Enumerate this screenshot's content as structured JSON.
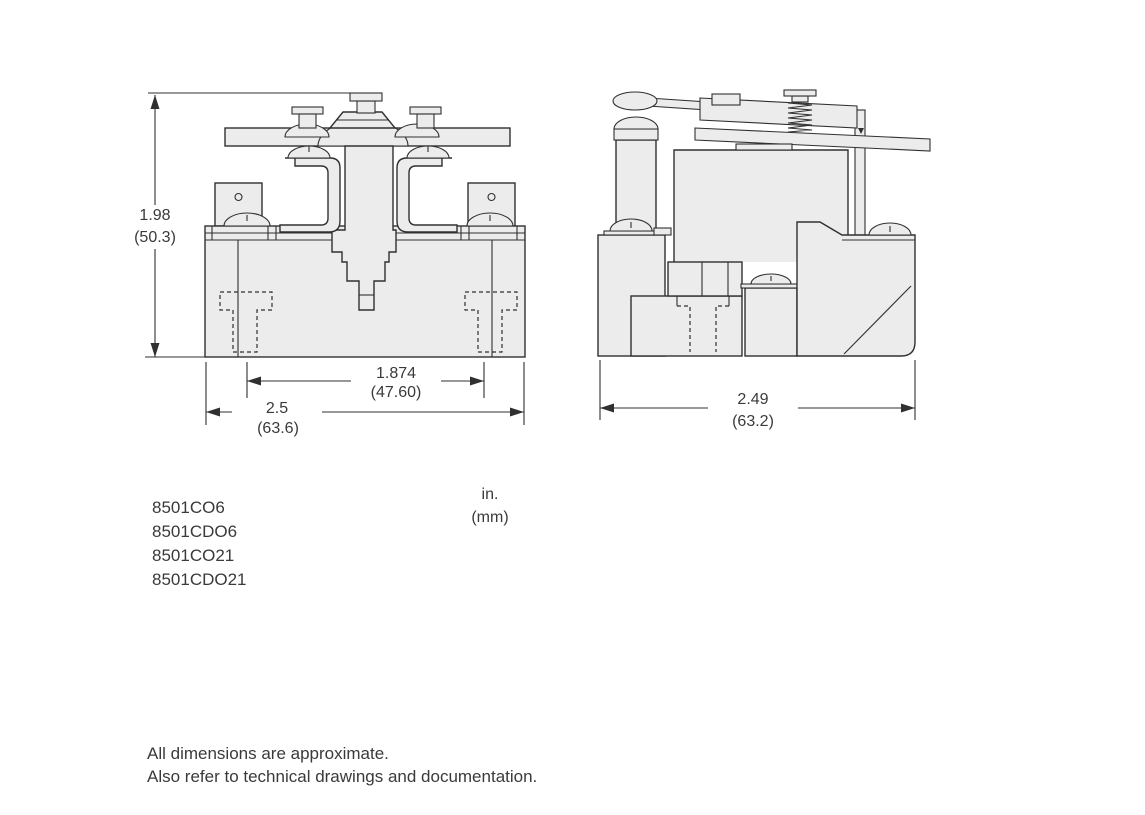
{
  "drawing": {
    "dimensions": {
      "height": {
        "in": "1.98",
        "mm": "(50.3)"
      },
      "mounting_width": {
        "in": "1.874",
        "mm": "(47.60)"
      },
      "overall_width": {
        "in": "2.5",
        "mm": "(63.6)"
      },
      "overall_depth": {
        "in": "2.49",
        "mm": "(63.2)"
      }
    },
    "units_legend": {
      "line1": "in.",
      "line2": "(mm)"
    }
  },
  "part_numbers": [
    "8501CO6",
    "8501CDO6",
    "8501CO21",
    "8501CDO21"
  ],
  "notes": [
    "All dimensions are approximate.",
    "Also refer to technical drawings and documentation."
  ],
  "colors": {
    "line": "#303030",
    "fill": "#ececec",
    "background": "#ffffff",
    "text": "#3a3a3a"
  }
}
